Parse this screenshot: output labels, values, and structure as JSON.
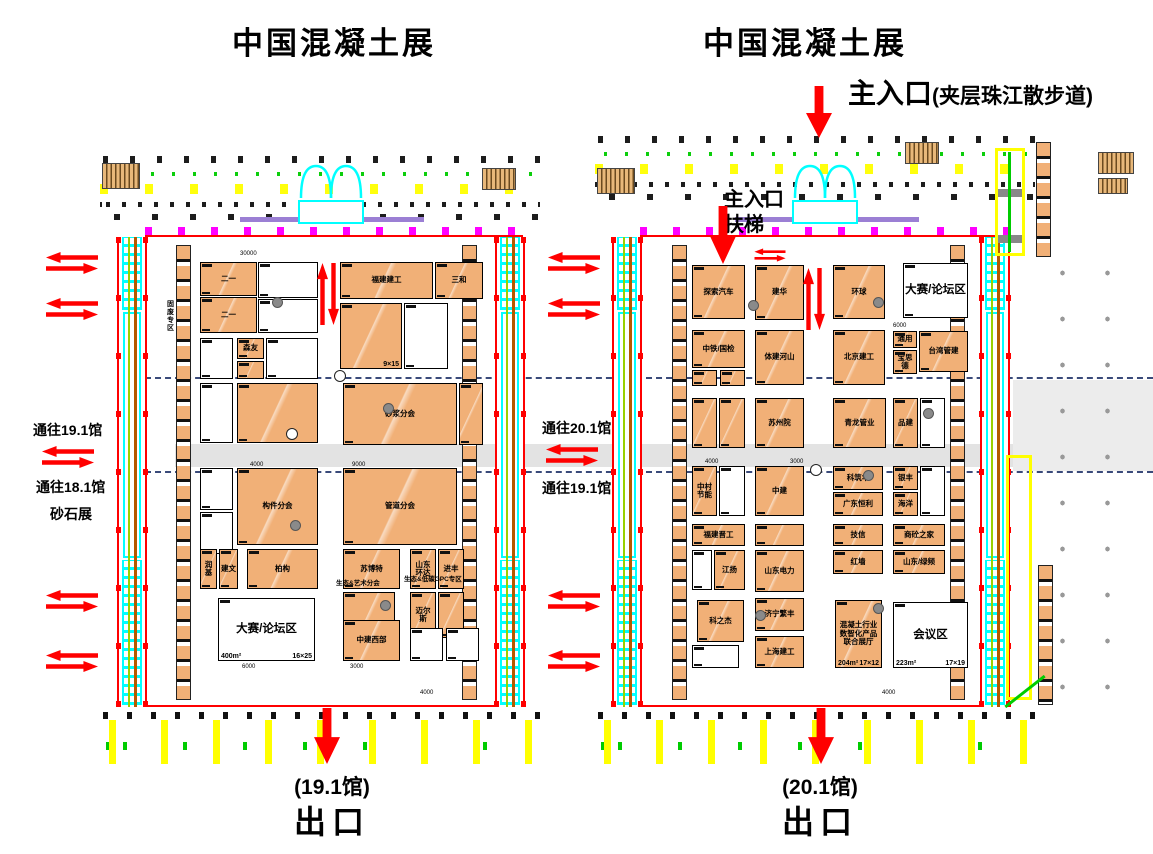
{
  "titles": {
    "left": "中国混凝土展",
    "right": "中国混凝土展"
  },
  "main_entrance": {
    "label": "主入口",
    "note": "(夹层珠江散步道)"
  },
  "hall2_entrance": {
    "line1": "主入口",
    "line2": "扶梯"
  },
  "routes": {
    "far_left": [
      "通往19.1馆",
      "通往18.1馆",
      "砂石展"
    ],
    "middle": [
      "通往20.1馆",
      "通往19.1馆"
    ]
  },
  "exits": {
    "left": {
      "hall": "(19.1馆)",
      "label": "出口"
    },
    "right": {
      "hall": "(20.1馆)",
      "label": "出口"
    }
  },
  "colors": {
    "booth_orange": "#F1B077",
    "arrow_red": "#FF0000",
    "aisle_gray": "#E3E3E3",
    "corridor_cyan": "#00FFFF",
    "highlight_yellow": "#FFFF00",
    "portal_magenta": "#FF00FF"
  },
  "halls": [
    {
      "name": "19.1馆",
      "labels": [
        {
          "t": "固废专区",
          "x": 166,
          "y": 300,
          "v": 1,
          "fs": 7
        },
        {
          "t": "生态&艺术分会",
          "x": 336,
          "y": 580,
          "fs": 6.5,
          "w": 72
        },
        {
          "t": "生态&低碳GPC专区",
          "x": 404,
          "y": 576,
          "fs": 6.5,
          "w": 76
        }
      ],
      "dims": [
        {
          "t": "30000",
          "x": 240,
          "y": 251
        },
        {
          "t": "4000",
          "x": 250,
          "y": 462
        },
        {
          "t": "9000",
          "x": 352,
          "y": 462
        },
        {
          "t": "6000",
          "x": 242,
          "y": 664
        },
        {
          "t": "3000",
          "x": 350,
          "y": 664
        },
        {
          "t": "4000",
          "x": 420,
          "y": 690
        }
      ],
      "booths": [
        {
          "x": 200,
          "y": 262,
          "w": 57,
          "h": 34,
          "f": "o",
          "n": "二一"
        },
        {
          "x": 200,
          "y": 297,
          "w": 57,
          "h": 36,
          "f": "o",
          "n": "二一"
        },
        {
          "x": 258,
          "y": 262,
          "w": 60,
          "h": 36,
          "f": "w"
        },
        {
          "x": 258,
          "y": 299,
          "w": 60,
          "h": 34,
          "f": "w"
        },
        {
          "x": 340,
          "y": 262,
          "w": 93,
          "h": 37,
          "f": "o",
          "n": "福建建工"
        },
        {
          "x": 435,
          "y": 262,
          "w": 48,
          "h": 37,
          "f": "o",
          "n": "三和"
        },
        {
          "x": 340,
          "y": 303,
          "w": 62,
          "h": 66,
          "f": "o",
          "d": "9×15"
        },
        {
          "x": 404,
          "y": 303,
          "w": 44,
          "h": 66,
          "f": "w"
        },
        {
          "x": 200,
          "y": 338,
          "w": 33,
          "h": 41,
          "f": "w"
        },
        {
          "x": 237,
          "y": 338,
          "w": 27,
          "h": 21,
          "f": "o",
          "n": "森友"
        },
        {
          "x": 237,
          "y": 361,
          "w": 27,
          "h": 18,
          "f": "o"
        },
        {
          "x": 266,
          "y": 338,
          "w": 52,
          "h": 41,
          "f": "w"
        },
        {
          "x": 200,
          "y": 383,
          "w": 33,
          "h": 60,
          "f": "w"
        },
        {
          "x": 237,
          "y": 383,
          "w": 81,
          "h": 60,
          "f": "o"
        },
        {
          "x": 343,
          "y": 383,
          "w": 114,
          "h": 62,
          "f": "o",
          "n": "砂浆分会"
        },
        {
          "x": 459,
          "y": 383,
          "w": 24,
          "h": 62,
          "f": "o"
        },
        {
          "x": 200,
          "y": 468,
          "w": 33,
          "h": 42,
          "f": "w"
        },
        {
          "x": 200,
          "y": 512,
          "w": 33,
          "h": 42,
          "f": "w"
        },
        {
          "x": 237,
          "y": 468,
          "w": 81,
          "h": 77,
          "f": "o",
          "n": "构件分会"
        },
        {
          "x": 343,
          "y": 468,
          "w": 114,
          "h": 77,
          "f": "o",
          "n": "管道分会"
        },
        {
          "x": 200,
          "y": 549,
          "w": 17,
          "h": 40,
          "f": "o",
          "n": "润基"
        },
        {
          "x": 219,
          "y": 549,
          "w": 19,
          "h": 40,
          "f": "o",
          "n": "建文"
        },
        {
          "x": 247,
          "y": 549,
          "w": 71,
          "h": 40,
          "f": "o",
          "n": "柏构"
        },
        {
          "x": 343,
          "y": 549,
          "w": 57,
          "h": 40,
          "f": "o",
          "n": "苏博特"
        },
        {
          "x": 410,
          "y": 549,
          "w": 26,
          "h": 40,
          "f": "o",
          "n": "山东环达"
        },
        {
          "x": 438,
          "y": 549,
          "w": 26,
          "h": 40,
          "f": "o",
          "n": "进丰"
        },
        {
          "x": 343,
          "y": 592,
          "w": 52,
          "h": 50,
          "f": "o"
        },
        {
          "x": 410,
          "y": 592,
          "w": 26,
          "h": 46,
          "f": "o",
          "n": "迈尔斯"
        },
        {
          "x": 438,
          "y": 592,
          "w": 26,
          "h": 46,
          "f": "o"
        },
        {
          "x": 218,
          "y": 598,
          "w": 97,
          "h": 63,
          "f": "w",
          "n": "大赛/论坛区",
          "s": "400m²",
          "d": "16×25",
          "big": 1
        },
        {
          "x": 343,
          "y": 620,
          "w": 57,
          "h": 41,
          "f": "o",
          "n": "中建西部"
        },
        {
          "x": 410,
          "y": 628,
          "w": 33,
          "h": 33,
          "f": "w"
        },
        {
          "x": 446,
          "y": 628,
          "w": 33,
          "h": 33,
          "f": "w"
        }
      ]
    },
    {
      "name": "20.1馆",
      "labels": [],
      "dims": [
        {
          "t": "6000",
          "x": 893,
          "y": 323
        },
        {
          "t": "4000",
          "x": 882,
          "y": 690
        },
        {
          "t": "4000",
          "x": 705,
          "y": 459
        },
        {
          "t": "3000",
          "x": 790,
          "y": 459
        }
      ],
      "booths": [
        {
          "x": 692,
          "y": 265,
          "w": 53,
          "h": 54,
          "f": "o",
          "n": "探索汽车"
        },
        {
          "x": 755,
          "y": 265,
          "w": 49,
          "h": 55,
          "f": "o",
          "n": "建华"
        },
        {
          "x": 833,
          "y": 265,
          "w": 52,
          "h": 54,
          "f": "o",
          "n": "环球"
        },
        {
          "x": 903,
          "y": 263,
          "w": 65,
          "h": 55,
          "f": "w",
          "n": "大赛/论坛区",
          "big": 1
        },
        {
          "x": 692,
          "y": 330,
          "w": 53,
          "h": 38,
          "f": "o",
          "n": "中铁/国检"
        },
        {
          "x": 692,
          "y": 370,
          "w": 25,
          "h": 16,
          "f": "o"
        },
        {
          "x": 720,
          "y": 370,
          "w": 25,
          "h": 16,
          "f": "o"
        },
        {
          "x": 755,
          "y": 330,
          "w": 49,
          "h": 55,
          "f": "o",
          "n": "体建河山"
        },
        {
          "x": 833,
          "y": 330,
          "w": 52,
          "h": 55,
          "f": "o",
          "n": "北京建工"
        },
        {
          "x": 893,
          "y": 331,
          "w": 24,
          "h": 17,
          "f": "o",
          "n": "通用"
        },
        {
          "x": 919,
          "y": 331,
          "w": 49,
          "h": 41,
          "f": "o",
          "n": "台湾管建"
        },
        {
          "x": 893,
          "y": 350,
          "w": 24,
          "h": 24,
          "f": "o",
          "n": "宝思德"
        },
        {
          "x": 692,
          "y": 398,
          "w": 25,
          "h": 50,
          "f": "o"
        },
        {
          "x": 719,
          "y": 398,
          "w": 26,
          "h": 50,
          "f": "o"
        },
        {
          "x": 755,
          "y": 398,
          "w": 49,
          "h": 50,
          "f": "o",
          "n": "苏州院"
        },
        {
          "x": 833,
          "y": 398,
          "w": 53,
          "h": 50,
          "f": "o",
          "n": "青龙管业"
        },
        {
          "x": 893,
          "y": 398,
          "w": 25,
          "h": 50,
          "f": "o",
          "n": "品建"
        },
        {
          "x": 920,
          "y": 398,
          "w": 25,
          "h": 50,
          "f": "w"
        },
        {
          "x": 692,
          "y": 466,
          "w": 25,
          "h": 50,
          "f": "o",
          "n": "中村节能"
        },
        {
          "x": 719,
          "y": 466,
          "w": 26,
          "h": 50,
          "f": "w"
        },
        {
          "x": 755,
          "y": 466,
          "w": 49,
          "h": 50,
          "f": "o",
          "n": "中建"
        },
        {
          "x": 833,
          "y": 466,
          "w": 50,
          "h": 24,
          "f": "o",
          "n": "科筑华"
        },
        {
          "x": 833,
          "y": 492,
          "w": 50,
          "h": 24,
          "f": "o",
          "n": "广东恒利"
        },
        {
          "x": 893,
          "y": 466,
          "w": 25,
          "h": 24,
          "f": "o",
          "n": "银丰"
        },
        {
          "x": 893,
          "y": 492,
          "w": 25,
          "h": 24,
          "f": "o",
          "n": "海洋"
        },
        {
          "x": 920,
          "y": 466,
          "w": 25,
          "h": 50,
          "f": "w"
        },
        {
          "x": 692,
          "y": 524,
          "w": 53,
          "h": 22,
          "f": "o",
          "n": "福建晋工"
        },
        {
          "x": 692,
          "y": 550,
          "w": 20,
          "h": 40,
          "f": "w"
        },
        {
          "x": 714,
          "y": 550,
          "w": 31,
          "h": 40,
          "f": "o",
          "n": "江扬"
        },
        {
          "x": 755,
          "y": 524,
          "w": 49,
          "h": 22,
          "f": "o"
        },
        {
          "x": 755,
          "y": 550,
          "w": 49,
          "h": 42,
          "f": "o",
          "n": "山东电力"
        },
        {
          "x": 833,
          "y": 524,
          "w": 50,
          "h": 22,
          "f": "o",
          "n": "技信"
        },
        {
          "x": 833,
          "y": 550,
          "w": 50,
          "h": 24,
          "f": "o",
          "n": "红墙"
        },
        {
          "x": 893,
          "y": 524,
          "w": 52,
          "h": 22,
          "f": "o",
          "n": "商砼之家"
        },
        {
          "x": 893,
          "y": 550,
          "w": 52,
          "h": 24,
          "f": "o",
          "n": "山东/绿频"
        },
        {
          "x": 697,
          "y": 600,
          "w": 47,
          "h": 42,
          "f": "o",
          "n": "科之杰"
        },
        {
          "x": 755,
          "y": 598,
          "w": 49,
          "h": 33,
          "f": "o",
          "n": "济宁繁丰"
        },
        {
          "x": 755,
          "y": 636,
          "w": 49,
          "h": 32,
          "f": "o",
          "n": "上海建工"
        },
        {
          "x": 692,
          "y": 645,
          "w": 47,
          "h": 23,
          "f": "w"
        },
        {
          "x": 835,
          "y": 600,
          "w": 47,
          "h": 68,
          "f": "o",
          "n": "混凝土行业数智化产品联合展厅",
          "s": "204m²",
          "d": "17×12"
        },
        {
          "x": 893,
          "y": 602,
          "w": 75,
          "h": 66,
          "f": "w",
          "n": "会议区",
          "s": "223m²",
          "d": "17×19",
          "big": 1
        }
      ]
    }
  ],
  "map": {
    "swap_arrows": [
      {
        "x": 46,
        "y": 252
      },
      {
        "x": 46,
        "y": 298
      },
      {
        "x": 42,
        "y": 446
      },
      {
        "x": 46,
        "y": 590
      },
      {
        "x": 46,
        "y": 650
      },
      {
        "x": 548,
        "y": 252
      },
      {
        "x": 548,
        "y": 298
      },
      {
        "x": 546,
        "y": 444
      },
      {
        "x": 548,
        "y": 590
      },
      {
        "x": 548,
        "y": 650
      },
      {
        "x": 744,
        "y": 244,
        "sm": 1
      }
    ],
    "vswap_arrows": [
      {
        "x": 317,
        "y": 263
      },
      {
        "x": 803,
        "y": 268
      }
    ],
    "down_arrows": [
      {
        "x": 806,
        "y": 86,
        "h": 52
      },
      {
        "x": 710,
        "y": 206,
        "h": 58
      },
      {
        "x": 314,
        "y": 708,
        "h": 56
      },
      {
        "x": 808,
        "y": 708,
        "h": 56
      }
    ],
    "circles": [
      {
        "x": 272,
        "y": 297,
        "t": "g"
      },
      {
        "x": 383,
        "y": 403,
        "t": "g"
      },
      {
        "x": 290,
        "y": 520,
        "t": "g"
      },
      {
        "x": 380,
        "y": 600,
        "t": "g"
      },
      {
        "x": 748,
        "y": 300,
        "t": "g"
      },
      {
        "x": 873,
        "y": 297,
        "t": "g"
      },
      {
        "x": 923,
        "y": 408,
        "t": "g"
      },
      {
        "x": 863,
        "y": 470,
        "t": "g"
      },
      {
        "x": 873,
        "y": 603,
        "t": "g"
      },
      {
        "x": 755,
        "y": 610,
        "t": "g"
      },
      {
        "x": 334,
        "y": 370,
        "t": "w"
      },
      {
        "x": 286,
        "y": 428,
        "t": "w"
      },
      {
        "x": 810,
        "y": 464,
        "t": "w"
      }
    ]
  }
}
